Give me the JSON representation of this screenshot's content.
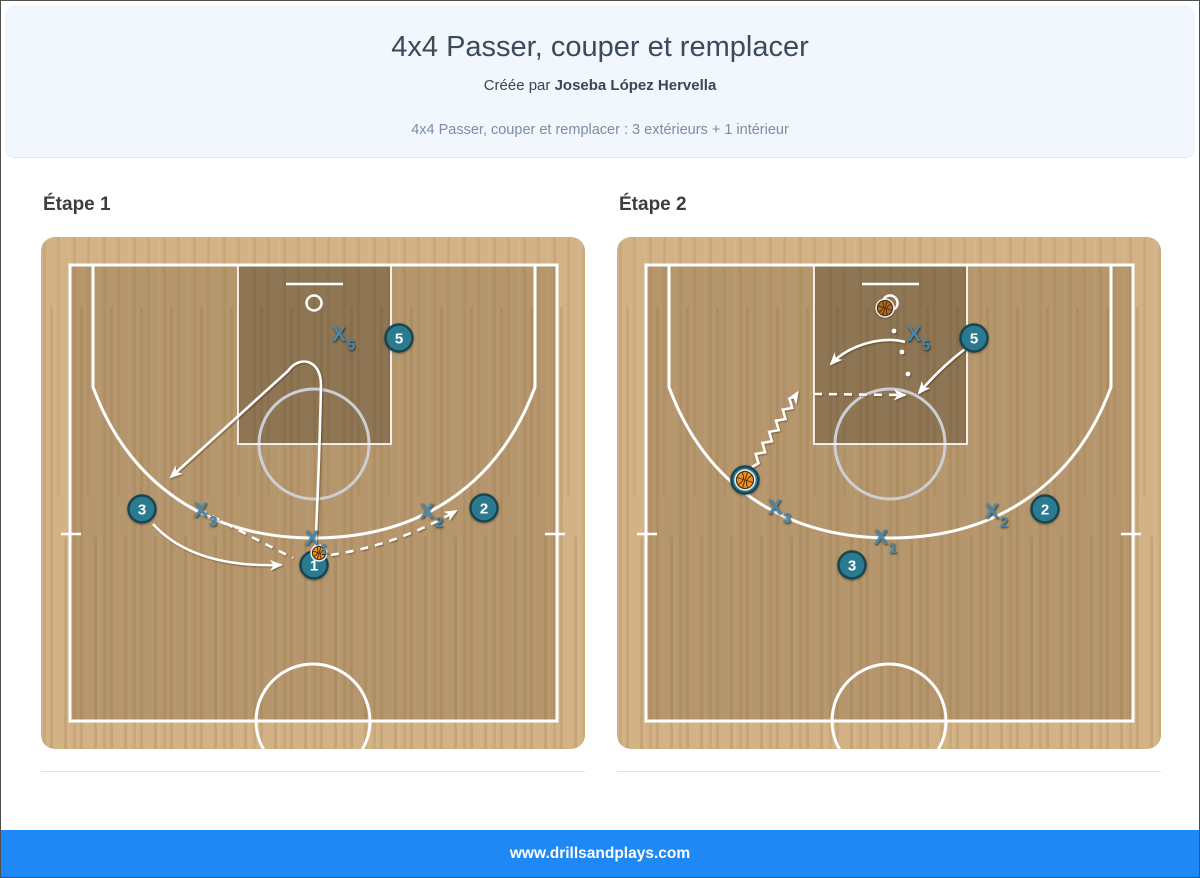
{
  "header": {
    "title": "4x4 Passer, couper et remplacer",
    "byline_prefix": "Créée par",
    "author": "Joseba López Hervella",
    "subtitle": "4x4 Passer, couper et remplacer : 3 extérieurs + 1 intérieur"
  },
  "footer": {
    "website": "www.drillsandplays.com"
  },
  "colors": {
    "footer_blue": "#1E88F5",
    "header_bg": "#F1F7FD",
    "court_light": "#D3B285",
    "court_inner_shade": "rgba(70,45,15,0.20)",
    "court_key_shade": "rgba(50,40,22,0.30)",
    "court_line": "#FFFFFF",
    "ft_circle": "#CDCED4",
    "player_fill": "#2B7B90",
    "player_stroke": "#1A4550",
    "defender_label": "#4788AC",
    "ball_bright": "#EE8E1C",
    "ball_dark": "#B06A20",
    "ball_seam": "#4A2B10"
  },
  "steps": [
    {
      "label": "Étape 1",
      "offense": [
        {
          "number": "5",
          "x": 358,
          "y": 101
        },
        {
          "number": "3",
          "x": 101,
          "y": 272
        },
        {
          "number": "2",
          "x": 443,
          "y": 271
        },
        {
          "number": "1",
          "x": 273,
          "y": 328
        }
      ],
      "defense": [
        {
          "number": "5",
          "x": 298,
          "y": 97
        },
        {
          "number": "3",
          "x": 160,
          "y": 273
        },
        {
          "number": "1",
          "x": 271,
          "y": 301
        },
        {
          "number": "2",
          "x": 386,
          "y": 274
        }
      ],
      "balls": [
        {
          "x": 278,
          "y": 316,
          "r": 6.5,
          "variant": "bright"
        }
      ],
      "shot_dots": [],
      "lines": [
        {
          "name": "cut-player-1",
          "style": "solid",
          "arrow": true,
          "path": "M 274 318 C 277 255 279 200 280 148 C 280 122 258 118 247 134 L 130 240"
        },
        {
          "name": "replace-player-3",
          "style": "solid",
          "arrow": true,
          "path": "M 112 287 Q 152 331 240 328"
        },
        {
          "name": "pass-1-to-2",
          "style": "dashed",
          "arrow": true,
          "path": "M 290 318 Q 356 308 415 274"
        },
        {
          "name": "slide-x3",
          "style": "dashed",
          "arrow": false,
          "path": "M 158 272 Q 208 299 252 321"
        }
      ]
    },
    {
      "label": "Étape 2",
      "offense": [
        {
          "number": "5",
          "x": 357,
          "y": 101
        },
        {
          "number": "2",
          "x": 428,
          "y": 272
        },
        {
          "number": "3",
          "x": 235,
          "y": 328
        },
        {
          "number": "",
          "x": 128,
          "y": 243
        }
      ],
      "defense": [
        {
          "number": "5",
          "x": 297,
          "y": 97
        },
        {
          "number": "3",
          "x": 158,
          "y": 270
        },
        {
          "number": "1",
          "x": 264,
          "y": 300
        },
        {
          "number": "2",
          "x": 375,
          "y": 274
        }
      ],
      "balls": [
        {
          "x": 128,
          "y": 243,
          "r": 8.5,
          "variant": "bright"
        },
        {
          "x": 268,
          "y": 71,
          "r": 7.5,
          "variant": "dark"
        }
      ],
      "shot_dots": [
        [
          277,
          94
        ],
        [
          285,
          115
        ],
        [
          291,
          137
        ]
      ],
      "lines": [
        {
          "name": "dribble-to-elbow",
          "style": "zigzag",
          "arrow": true,
          "from": [
            135,
            230
          ],
          "to": [
            179,
            158
          ]
        },
        {
          "name": "pass-to-5",
          "style": "dashed",
          "arrow": true,
          "path": "M 197 157 L 288 158"
        },
        {
          "name": "cut-player-5",
          "style": "solid",
          "arrow": true,
          "path": "M 348 112 Q 322 132 302 156"
        },
        {
          "name": "move-x5",
          "style": "solid",
          "arrow": true,
          "path": "M 288 105 C 266 99 233 107 214 127"
        }
      ]
    }
  ]
}
